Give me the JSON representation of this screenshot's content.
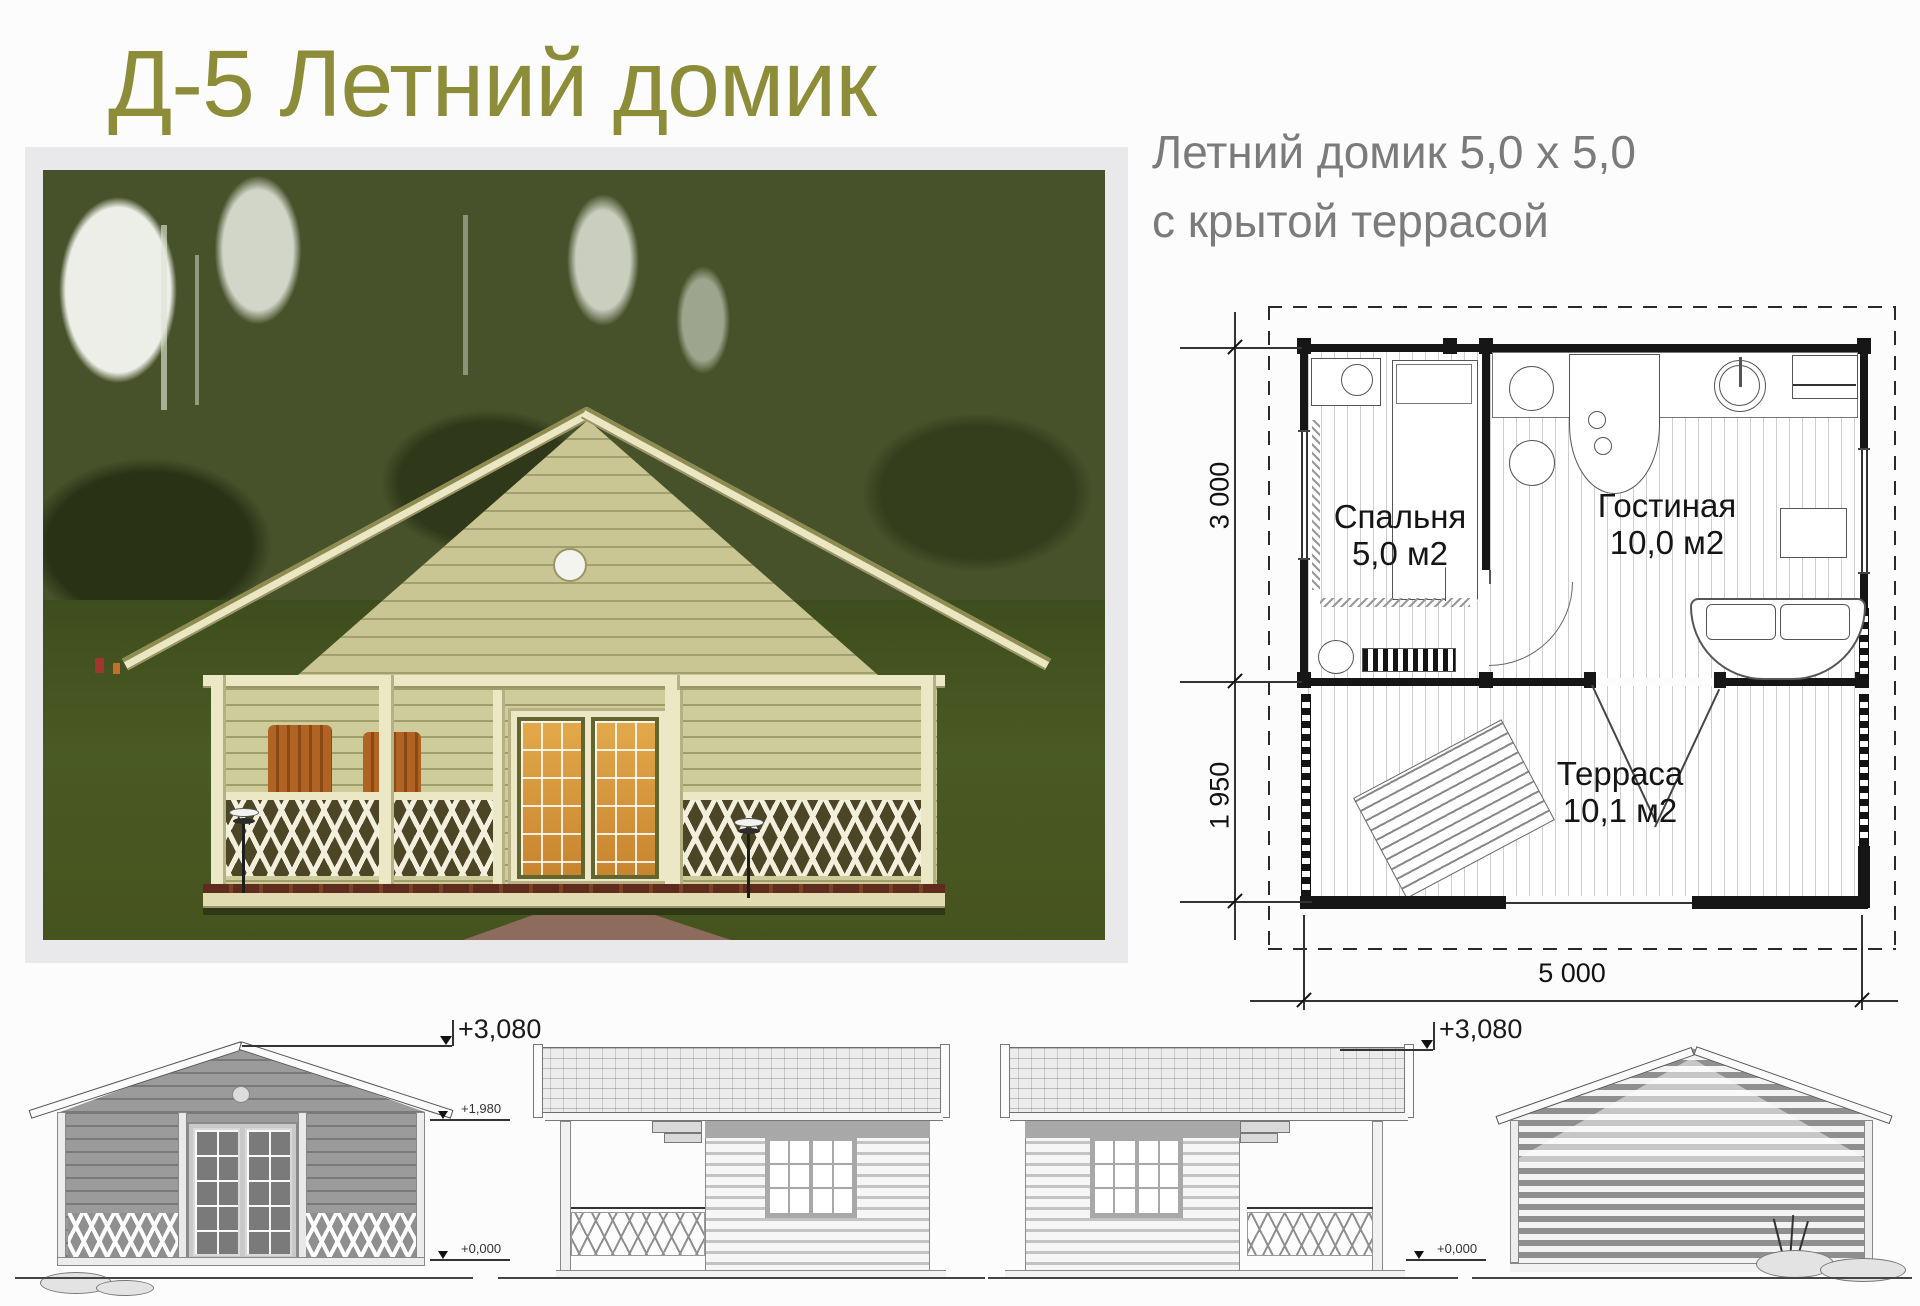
{
  "page": {
    "title": "Д-5 Летний домик"
  },
  "intro": {
    "line1": "Летний домик 5,0 х 5,0",
    "line2": "с крытой террасой"
  },
  "floor_plan": {
    "rooms": [
      {
        "name": "Спальня",
        "area": "5,0 м2"
      },
      {
        "name": "Гостиная",
        "area": "10,0 м2"
      },
      {
        "name": "Терраса",
        "area": "10,1 м2"
      }
    ],
    "dimensions": {
      "depth_main": "3 000",
      "depth_terrace": "1 950",
      "width": "5 000"
    }
  },
  "elevations": {
    "marks": {
      "ridge": "+3,080",
      "eaves": "+1,980",
      "zero": "+0,000"
    }
  },
  "colors": {
    "title": "#8d8d39",
    "subtitle": "#7b7b7b",
    "accent_wall": "#cfcc9b"
  }
}
